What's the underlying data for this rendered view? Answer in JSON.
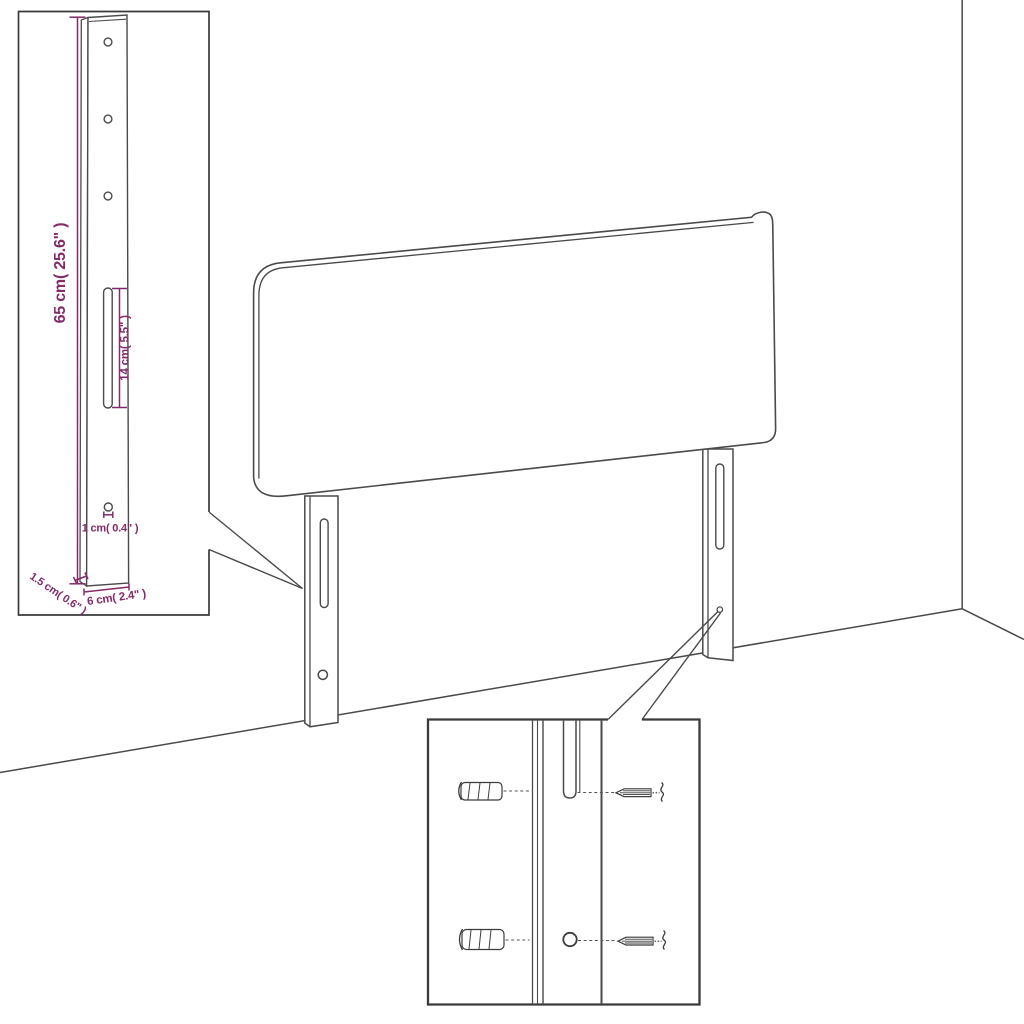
{
  "diagram": {
    "kind": "headboard assembly dimension diagram",
    "colors": {
      "line": "#4a4a4a",
      "dimension": "#842a68",
      "inset_border": "#3a3a3a",
      "background": "#ffffff"
    },
    "bracket_inset": {
      "height_label": "65 cm( 25.6\" )",
      "slot_label": "14 cm( 5.5\" )",
      "hole_label": "1 cm( 0.4\" )",
      "depth_label": "1.5 cm( 0.6\" )",
      "width_label": "6 cm( 2.4\" )"
    }
  }
}
